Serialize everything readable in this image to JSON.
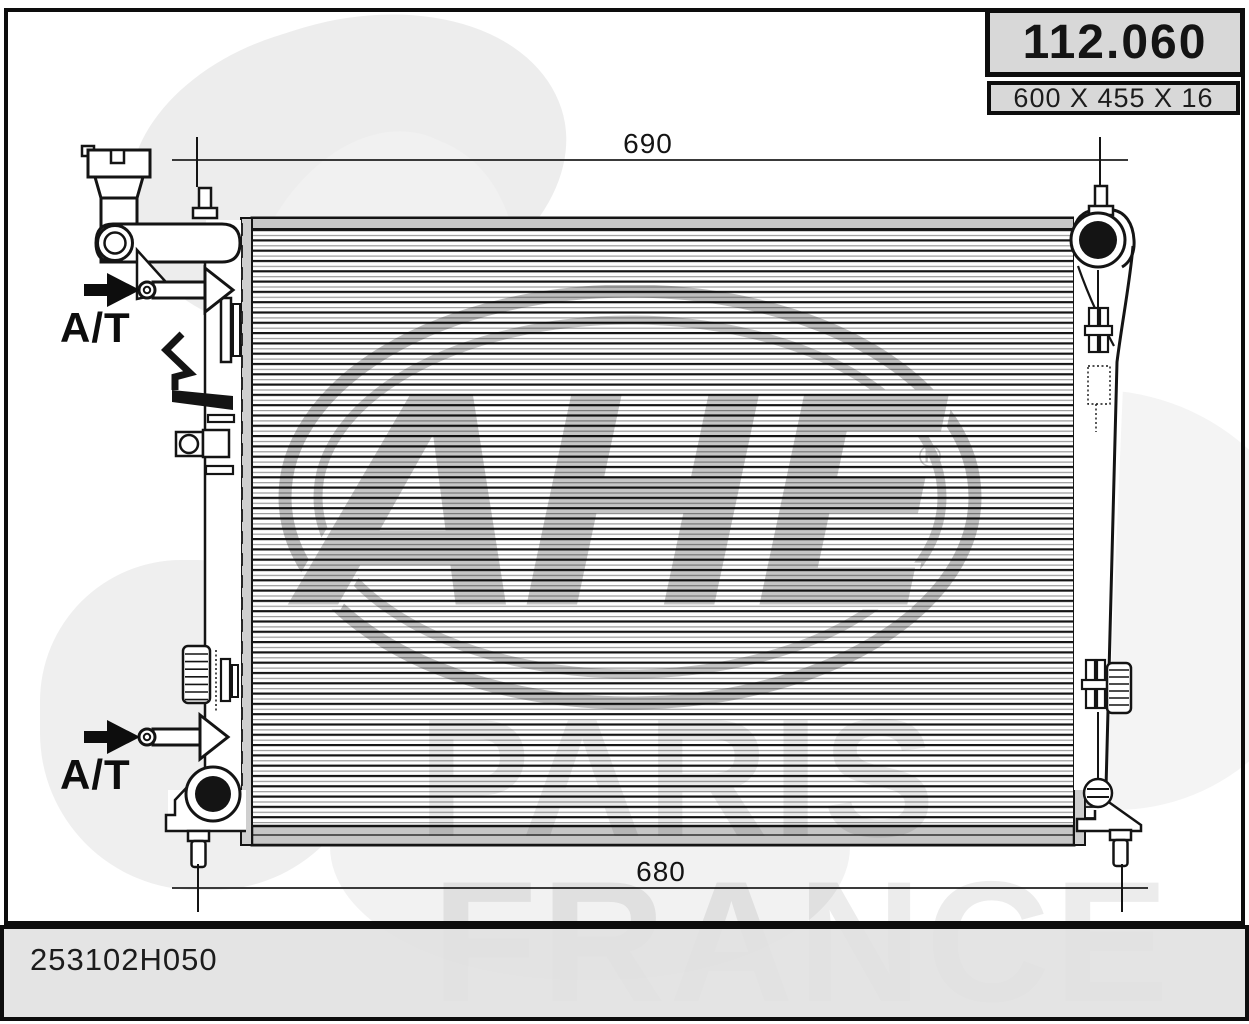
{
  "title_block": {
    "part_number": "112.060",
    "size": "600 X 455 X 16"
  },
  "dimensions": {
    "top_width": "690",
    "bottom_width": "680"
  },
  "flow_labels": {
    "upper": "A/T",
    "lower": "A/T"
  },
  "footer": {
    "reference": "253102H050"
  },
  "watermark": {
    "brand": "AHE",
    "registered_mark": "®",
    "city": "PARIS",
    "country": "FRANCE"
  },
  "colors": {
    "ink": "#141414",
    "panel_gray": "#d8d8d8",
    "band_gray": "#c6c6c6",
    "castellation_gray": "#cfcfcf",
    "watermark_gray": "#c6c6c6",
    "watermark_light": "#eaeaea",
    "footer_bg": "#e2e2e2"
  }
}
